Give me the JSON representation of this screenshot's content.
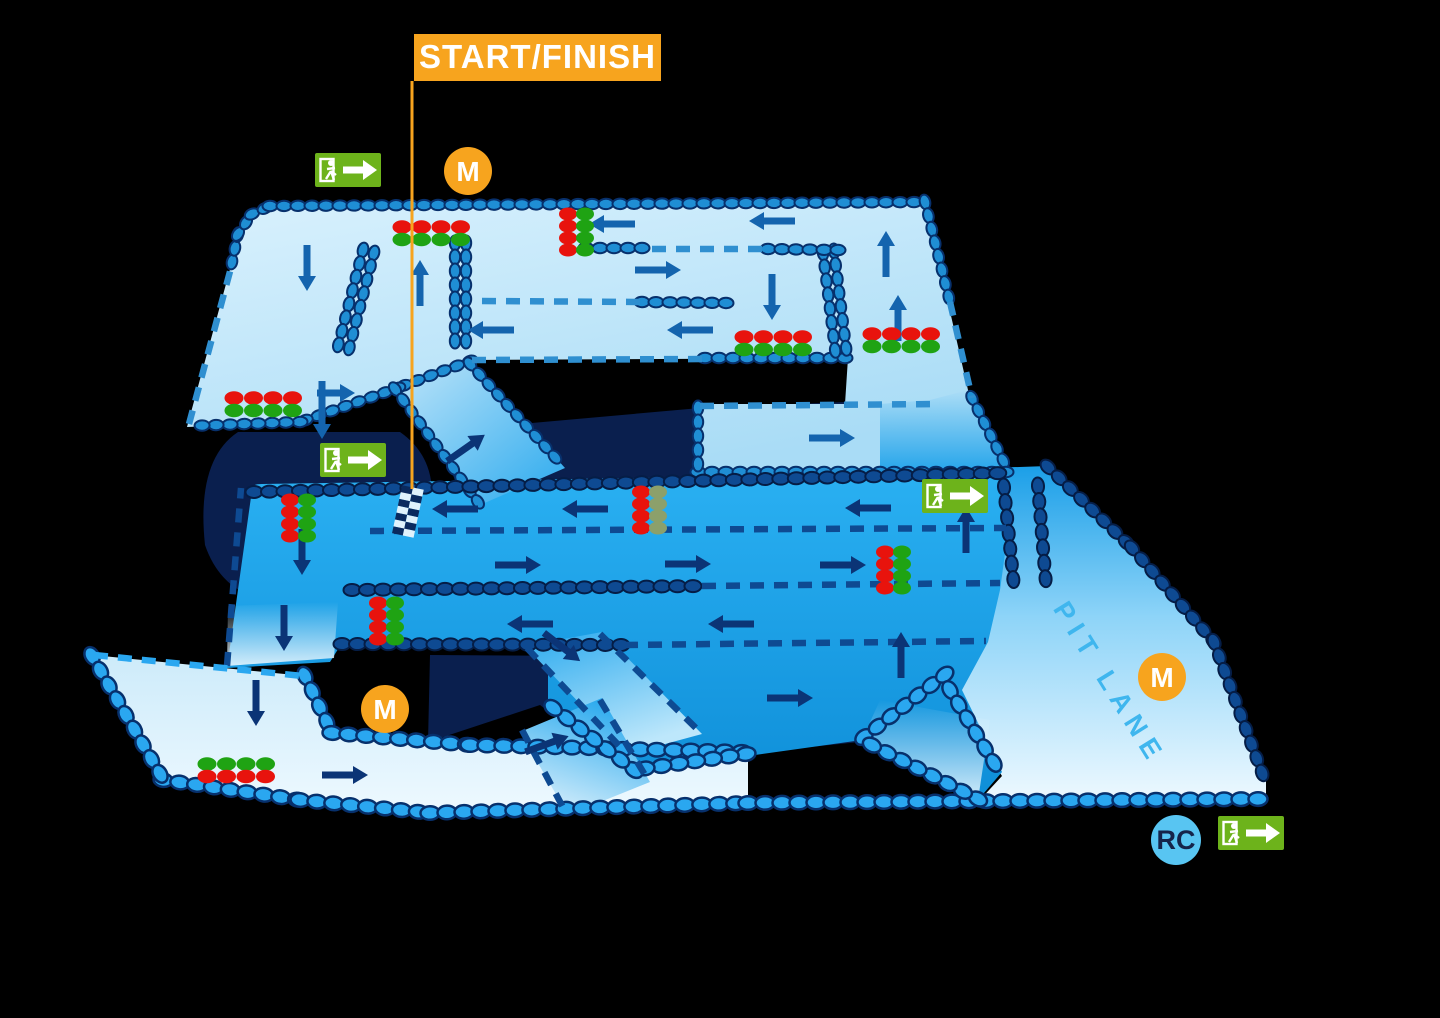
{
  "diagram": {
    "type": "karting-track-map",
    "levels": [
      "upper-track",
      "lower-track",
      "ground-level",
      "pit-lane"
    ]
  },
  "labels": {
    "start_finish": "START/FINISH",
    "pit_lane": "PIT LANE",
    "marshal_post": "M",
    "race_control": "RC"
  },
  "colors": {
    "background": "#000000",
    "shadow": "#0a1f4e",
    "upper_track_light": "#d7f0fd",
    "upper_track_deep": "#a9dcf6",
    "lower_track_top": "#2ab0f2",
    "lower_track_bottom": "#0e8ed8",
    "ground_track": "#ddf1fc",
    "barrier_upper": "#1f8ed4",
    "barrier_lower": "#0e4a92",
    "barrier_bright": "#2aa7f0",
    "barrier_outline": "#07306c",
    "arrow_upper": "#1464ae",
    "arrow_lower": "#0b3476",
    "accent_orange": "#f7a41e",
    "exit_green": "#6db31b",
    "light_red": "#e8130d",
    "light_green": "#1fa313",
    "light_green_dim": "#8ca06b",
    "rc_blue": "#58c5f2",
    "rc_text": "#15244a",
    "pit_text": "#3fb6ee",
    "checker_dark": "#0a2a5e",
    "checker_light": "#dff2fc"
  },
  "start_finish": {
    "banner": {
      "x": 414,
      "y": 34,
      "w": 247,
      "h": 47
    },
    "line_x": 412,
    "line_y1": 81,
    "line_y2": 489,
    "checker": {
      "x": 408,
      "y": 511,
      "rotate": 12
    }
  },
  "marshal_posts": [
    {
      "x": 468,
      "y": 171
    },
    {
      "x": 385,
      "y": 709
    },
    {
      "x": 1162,
      "y": 677
    }
  ],
  "race_control": {
    "x": 1176,
    "y": 840
  },
  "exit_signs": [
    {
      "x": 315,
      "y": 153
    },
    {
      "x": 320,
      "y": 443
    },
    {
      "x": 922,
      "y": 479
    },
    {
      "x": 1218,
      "y": 816
    }
  ],
  "pit_lane_text": {
    "x": 1102,
    "y": 688,
    "rotate": 58
  },
  "traffic_lights": [
    {
      "id": "TL1",
      "x": 402,
      "y": 227,
      "orientation": "horizontal",
      "rows": [
        "red",
        "green"
      ],
      "count": 4,
      "level": "upper"
    },
    {
      "id": "TL2",
      "x": 744,
      "y": 337,
      "orientation": "horizontal",
      "rows": [
        "red",
        "green"
      ],
      "count": 4,
      "level": "upper"
    },
    {
      "id": "TL3",
      "x": 872,
      "y": 334,
      "orientation": "horizontal",
      "rows": [
        "red",
        "green"
      ],
      "count": 4,
      "level": "upper"
    },
    {
      "id": "TL4",
      "x": 234,
      "y": 398,
      "orientation": "horizontal",
      "rows": [
        "red",
        "green"
      ],
      "count": 4,
      "level": "upper"
    },
    {
      "id": "TL5",
      "x": 568,
      "y": 214,
      "orientation": "vertical",
      "cols": [
        "red",
        "green"
      ],
      "count": 4,
      "level": "upper"
    },
    {
      "id": "TL6",
      "x": 290,
      "y": 500,
      "orientation": "vertical",
      "cols": [
        "red",
        "green"
      ],
      "count": 4,
      "level": "lower"
    },
    {
      "id": "TL7",
      "x": 378,
      "y": 603,
      "orientation": "vertical",
      "cols": [
        "red",
        "green"
      ],
      "count": 4,
      "level": "lower"
    },
    {
      "id": "TL8",
      "x": 641,
      "y": 492,
      "orientation": "vertical",
      "cols": [
        "red",
        "green_dim"
      ],
      "count": 4,
      "level": "lower"
    },
    {
      "id": "TL9",
      "x": 885,
      "y": 552,
      "orientation": "vertical",
      "cols": [
        "red",
        "green"
      ],
      "count": 4,
      "level": "lower"
    },
    {
      "id": "TL10",
      "x": 207,
      "y": 764,
      "orientation": "horizontal",
      "rows": [
        "green",
        "red"
      ],
      "count": 4,
      "level": "ground"
    }
  ],
  "arrows": [
    {
      "x": 307,
      "y": 268,
      "rot": 90,
      "tier": "upper"
    },
    {
      "x": 420,
      "y": 283,
      "rot": 270,
      "tier": "upper"
    },
    {
      "x": 322,
      "y": 410,
      "rot": 90,
      "tier": "upper",
      "len": 58
    },
    {
      "x": 336,
      "y": 393,
      "rot": 0,
      "tier": "upper",
      "len": 38
    },
    {
      "x": 612,
      "y": 224,
      "rot": 180,
      "tier": "upper"
    },
    {
      "x": 772,
      "y": 221,
      "rot": 180,
      "tier": "upper"
    },
    {
      "x": 658,
      "y": 270,
      "rot": 0,
      "tier": "upper"
    },
    {
      "x": 491,
      "y": 330,
      "rot": 180,
      "tier": "upper"
    },
    {
      "x": 690,
      "y": 330,
      "rot": 180,
      "tier": "upper"
    },
    {
      "x": 772,
      "y": 297,
      "rot": 90,
      "tier": "upper"
    },
    {
      "x": 886,
      "y": 254,
      "rot": 270,
      "tier": "upper"
    },
    {
      "x": 898,
      "y": 318,
      "rot": 270,
      "tier": "upper"
    },
    {
      "x": 832,
      "y": 438,
      "rot": 0,
      "tier": "upper"
    },
    {
      "x": 466,
      "y": 448,
      "rot": -35,
      "tier": "lower"
    },
    {
      "x": 455,
      "y": 509,
      "rot": 180,
      "tier": "lower"
    },
    {
      "x": 585,
      "y": 509,
      "rot": 180,
      "tier": "lower"
    },
    {
      "x": 868,
      "y": 508,
      "rot": 180,
      "tier": "lower"
    },
    {
      "x": 518,
      "y": 565,
      "rot": 0,
      "tier": "lower"
    },
    {
      "x": 688,
      "y": 564,
      "rot": 0,
      "tier": "lower"
    },
    {
      "x": 843,
      "y": 565,
      "rot": 0,
      "tier": "lower"
    },
    {
      "x": 530,
      "y": 624,
      "rot": 180,
      "tier": "lower"
    },
    {
      "x": 731,
      "y": 624,
      "rot": 180,
      "tier": "lower"
    },
    {
      "x": 302,
      "y": 552,
      "rot": 90,
      "tier": "lower"
    },
    {
      "x": 284,
      "y": 628,
      "rot": 90,
      "tier": "lower"
    },
    {
      "x": 562,
      "y": 647,
      "rot": 38,
      "tier": "lower"
    },
    {
      "x": 790,
      "y": 698,
      "rot": 0,
      "tier": "lower"
    },
    {
      "x": 901,
      "y": 655,
      "rot": 270,
      "tier": "lower"
    },
    {
      "x": 966,
      "y": 530,
      "rot": 270,
      "tier": "lower"
    },
    {
      "x": 256,
      "y": 703,
      "rot": 90,
      "tier": "ground"
    },
    {
      "x": 345,
      "y": 775,
      "rot": 0,
      "tier": "ground"
    },
    {
      "x": 547,
      "y": 744,
      "rot": -20,
      "tier": "ground"
    }
  ]
}
